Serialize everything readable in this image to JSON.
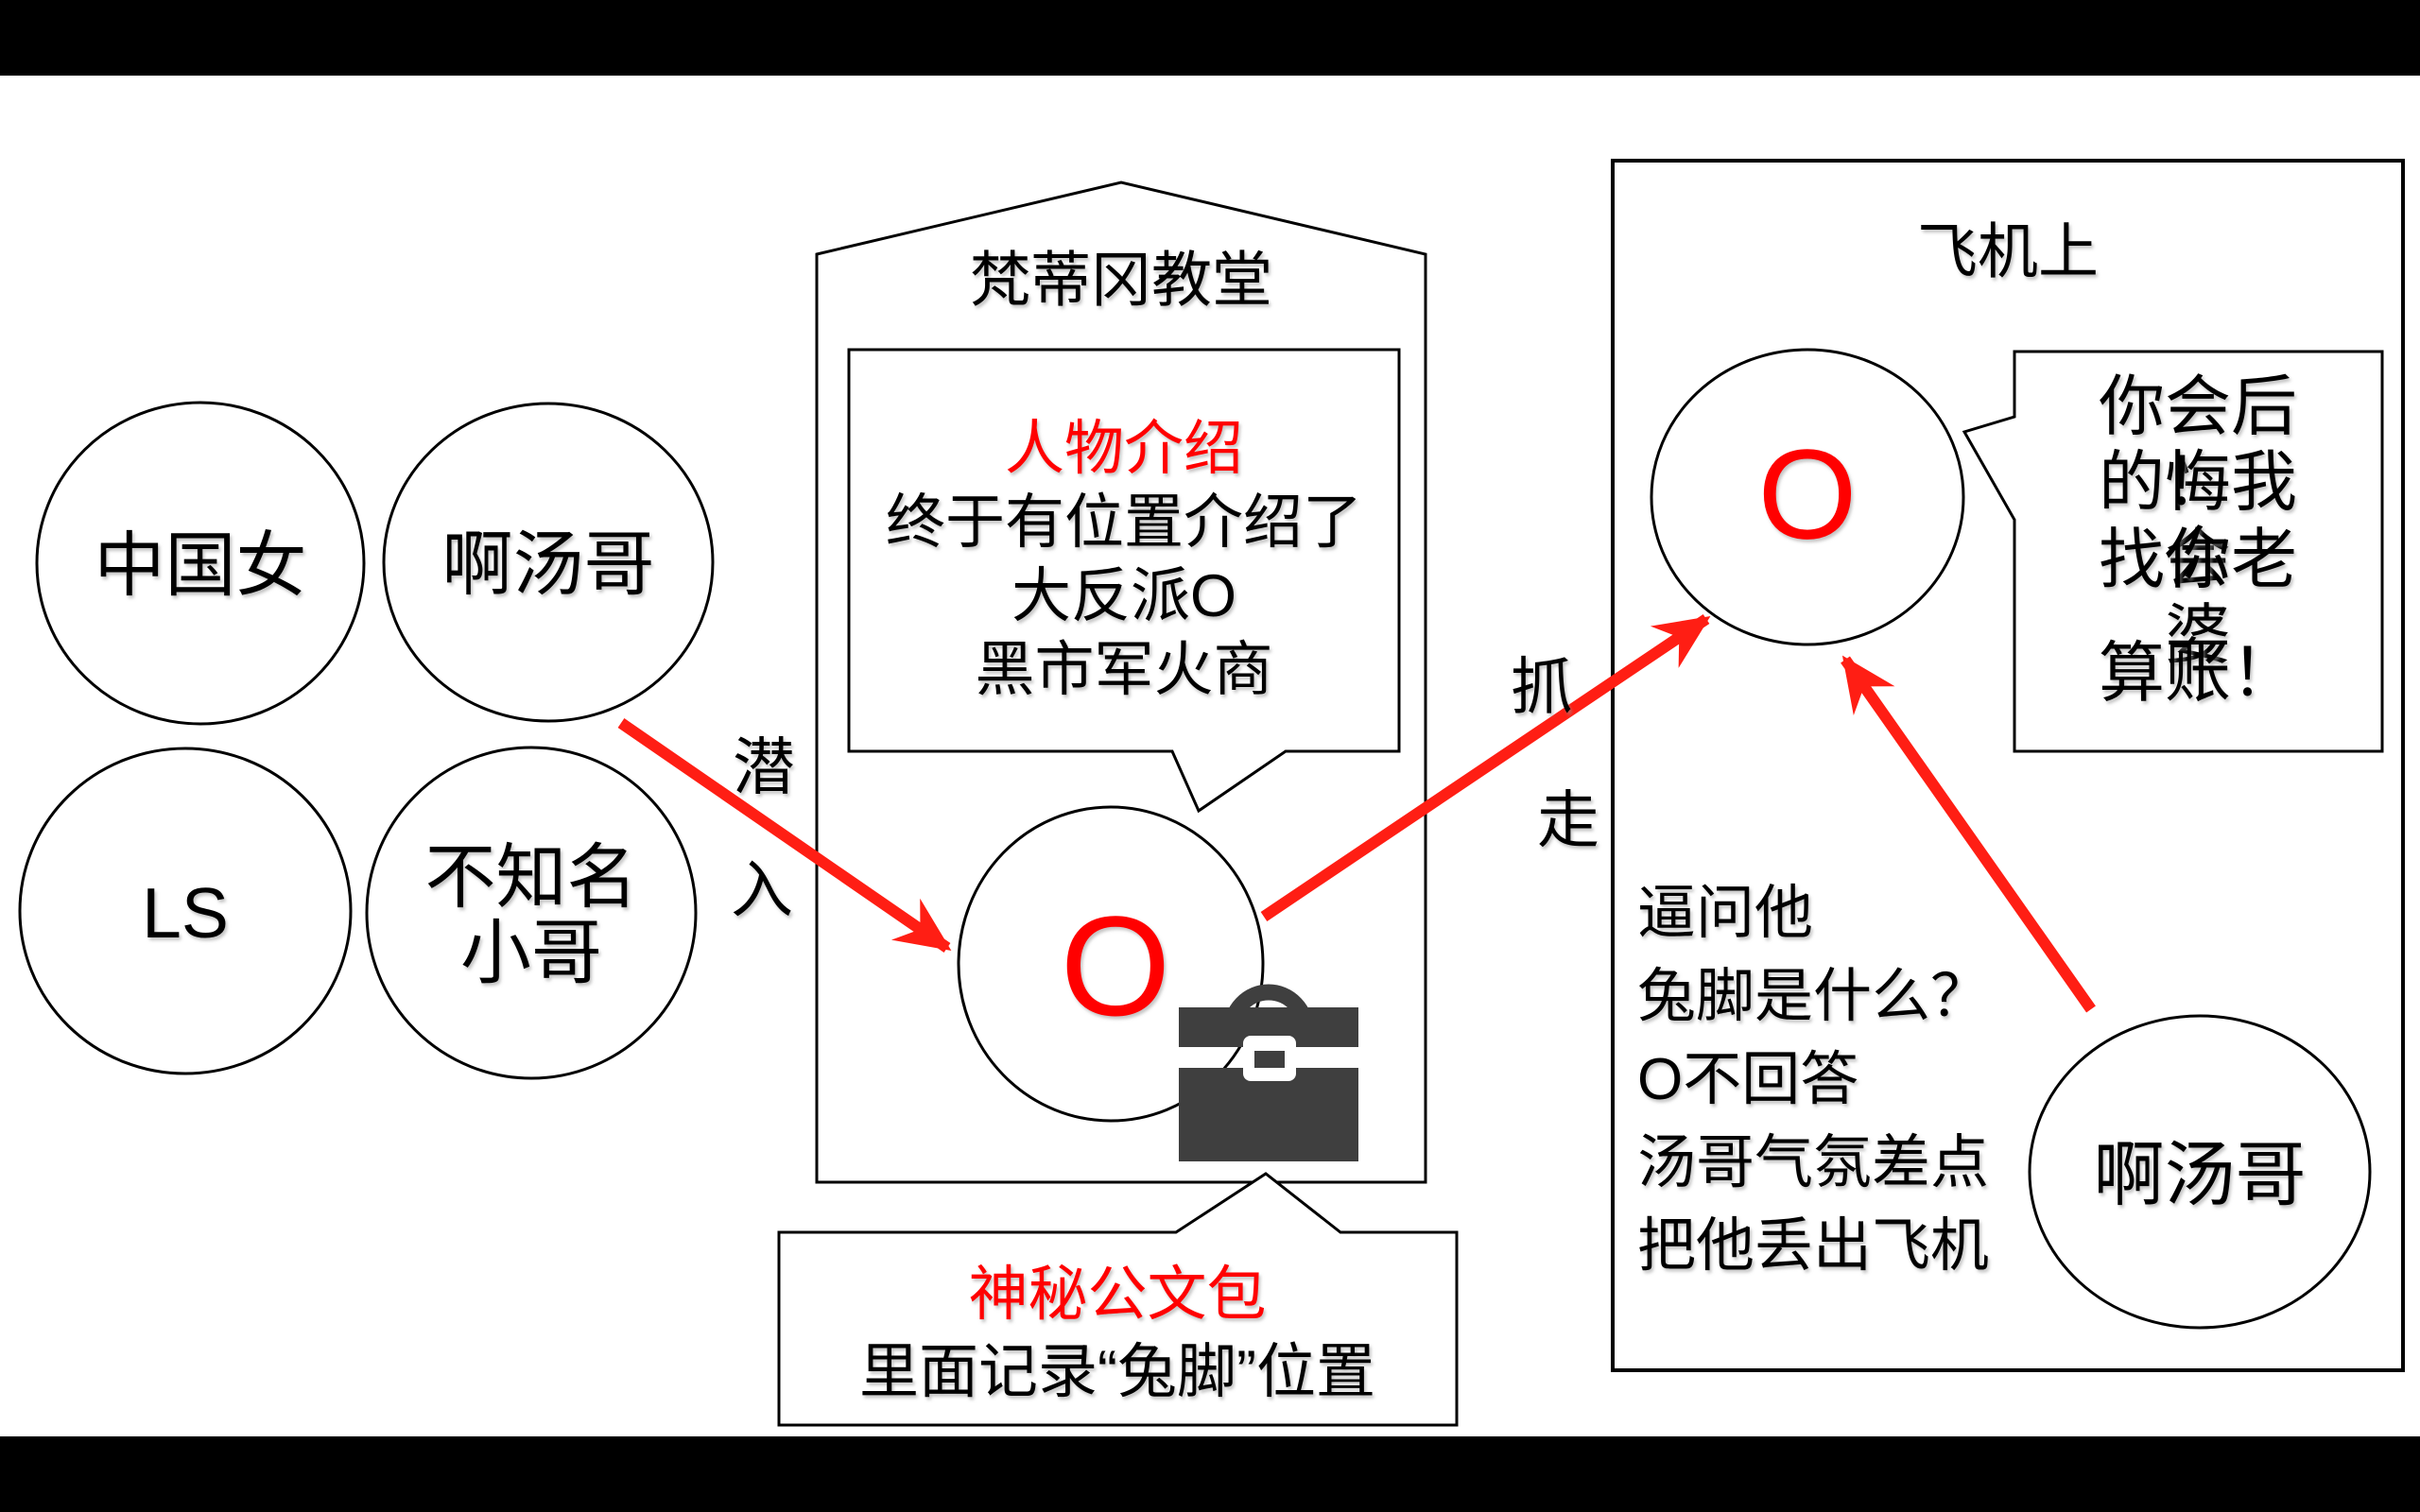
{
  "colors": {
    "background": "#000000",
    "canvas": "#FFFFFF",
    "outline": "#000000",
    "red_text": "#FF0000",
    "red_arrow": "#FF1E14",
    "briefcase": "#3F3F3F"
  },
  "characters": {
    "chinese_woman": "中国女",
    "tom": "啊汤哥",
    "ls": "LS",
    "unknown_guy": "不知名\n小哥",
    "villain_initial": "O"
  },
  "church": {
    "title": "梵蒂冈教堂",
    "intro_heading": "人物介绍",
    "intro_lines": [
      "终于有位置介绍了",
      "大反派O",
      "黑市军火商"
    ]
  },
  "briefcase_note": {
    "heading": "神秘公文包",
    "body": "里面记录“兔脚”位置"
  },
  "labels": {
    "sneak_1": "潜",
    "sneak_2": "入",
    "capture_1": "抓",
    "capture_2": "走"
  },
  "plane": {
    "title": "飞机上",
    "villain_initial": "O",
    "threat_lines": [
      "你会后悔",
      "的！我会",
      "找你老婆",
      "算账！"
    ],
    "narration_lines": [
      "逼问他",
      "兔脚是什么？",
      "O不回答",
      "汤哥气氛差点",
      "把他丢出飞机"
    ],
    "tom": "啊汤哥"
  }
}
